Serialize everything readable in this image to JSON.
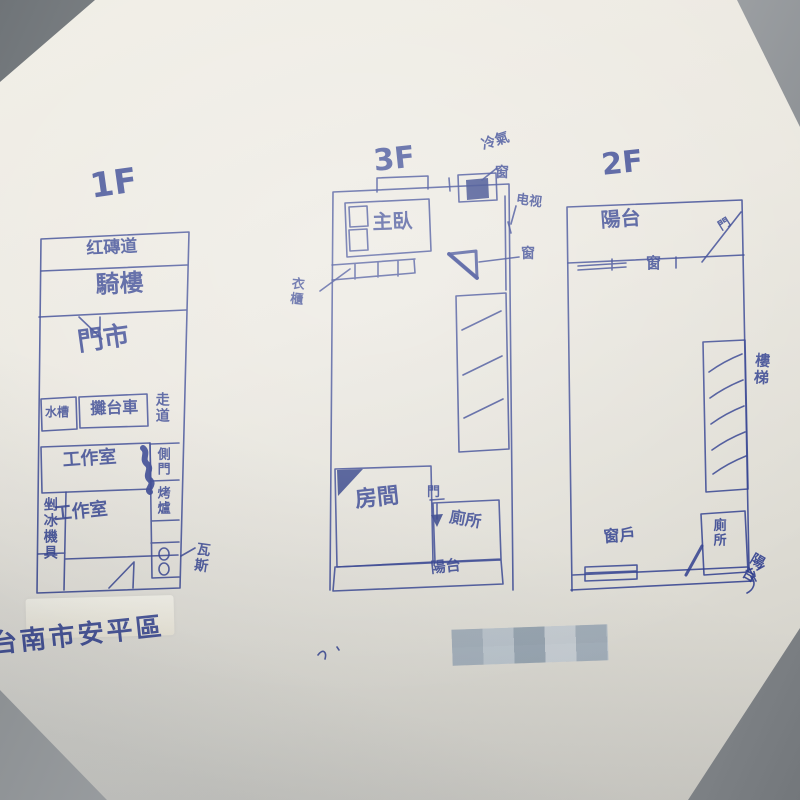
{
  "colors": {
    "ink": "#2b3a8c",
    "paper": "#eae7df",
    "desk": "#85898d",
    "whiteout": "#f3f1e7"
  },
  "caption": {
    "text": "台南市安平區"
  },
  "plans": {
    "f1": {
      "title": "1F",
      "sidewalk": "红磚道",
      "arcade": "騎樓",
      "shop": "門市",
      "sink": "水槽",
      "cart": "攤台車",
      "aisle": "走道",
      "studio_a": "工作室",
      "studio_b": "工作室",
      "ice_gear": "剉冰機具",
      "side_door": "側門",
      "oven": "烤爐",
      "gas": "瓦斯"
    },
    "f3": {
      "title": "3F",
      "ac": "冷氣",
      "window_top": "窗",
      "tv": "电视",
      "master_bed": "主臥",
      "wardrobe": "衣櫃",
      "window_side": "窗",
      "room": "房間",
      "door": "門",
      "toilet": "廁所",
      "balcony": "陽台"
    },
    "f2": {
      "title": "2F",
      "balcony_top": "陽台",
      "door": "門",
      "window_wall": "窗",
      "stairs": "樓梯",
      "window_bottom": "窗戶",
      "toilet": "廁所",
      "balcony_bottom": "陽台"
    }
  }
}
